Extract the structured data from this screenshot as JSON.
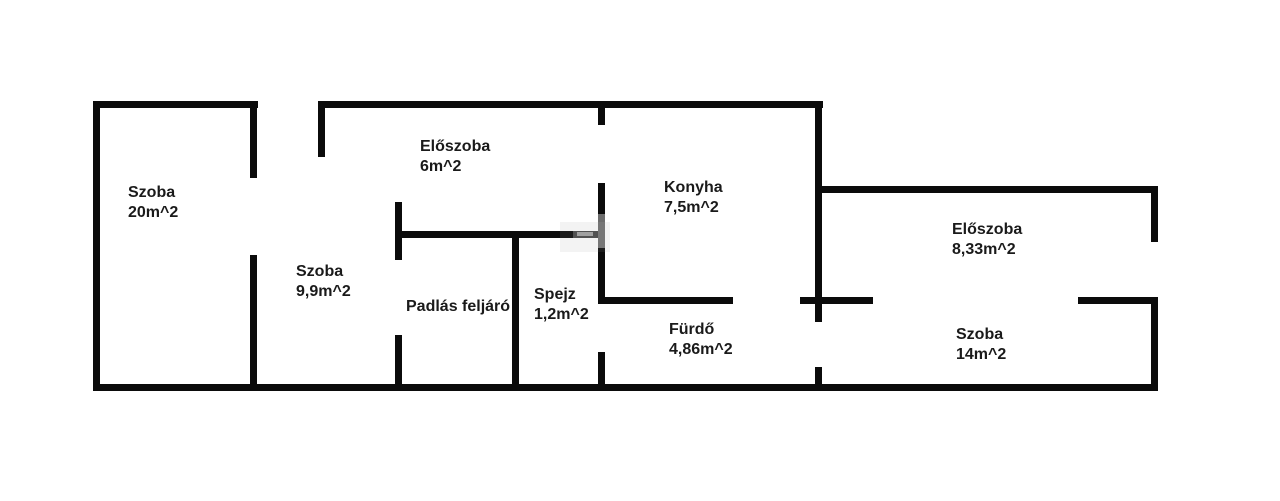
{
  "plan": {
    "background": "#ffffff",
    "wall_color": "#0b0b0b",
    "text_color": "#1a1a1a"
  },
  "rooms": [
    {
      "id": "szoba-20",
      "name": "Szoba",
      "area": "20m^2"
    },
    {
      "id": "eloszoba-6",
      "name": "Előszoba",
      "area": "6m^2"
    },
    {
      "id": "szoba-9-9",
      "name": "Szoba",
      "area": "9,9m^2"
    },
    {
      "id": "padlas-feljaro",
      "name": "Padlás feljáró",
      "area": ""
    },
    {
      "id": "spejz",
      "name": "Spejz",
      "area": "1,2m^2"
    },
    {
      "id": "konyha",
      "name": "Konyha",
      "area": "7,5m^2"
    },
    {
      "id": "furdo",
      "name": "Fürdő",
      "area": "4,86m^2"
    },
    {
      "id": "eloszoba-8-33",
      "name": "Előszoba",
      "area": "8,33m^2"
    },
    {
      "id": "szoba-14",
      "name": "Szoba",
      "area": "14m^2"
    }
  ]
}
